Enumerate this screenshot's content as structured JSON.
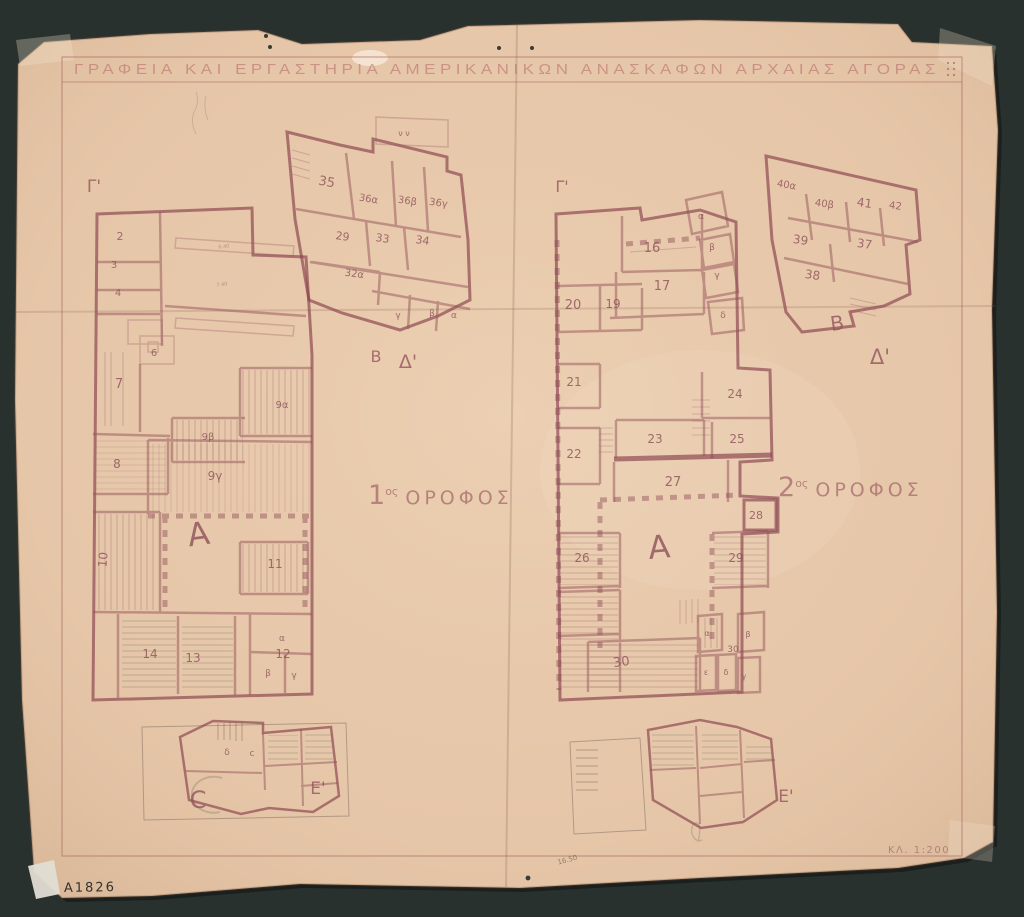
{
  "scene": {
    "title": "ΓΡΑΦΕΙΑ ΚΑΙ ΕΡΓΑΣΤΗΡΙΑ ΑΜΕΡΙΚΑΝΙΚΩΝ ΑΝΑΣΚΑΦΩΝ ΑΡΧΑΙΑΣ ΑΓΟΡΑΣ",
    "catalog_number": "A1826",
    "scale_label": "ΚΛ. 1:200",
    "background_color": "#2e3734",
    "paper_color": "#e8c8aa",
    "ink_color": "#9a5f68",
    "pencil_color": "#8a7568"
  },
  "floors": {
    "left": {
      "number": "1",
      "ordinal": "ος",
      "word": "ΟΡΟΦΟΣ"
    },
    "right": {
      "number": "2",
      "ordinal": "ος",
      "word": "ΟΡΟΦΟΣ"
    }
  },
  "plans": {
    "left": {
      "name": "first-floor-plan",
      "room_labels": [
        {
          "t": "2",
          "x": 120,
          "y": 240,
          "s": 11
        },
        {
          "t": "3",
          "x": 114,
          "y": 268,
          "s": 10
        },
        {
          "t": "4",
          "x": 118,
          "y": 296,
          "s": 10
        },
        {
          "t": "6",
          "x": 154,
          "y": 356,
          "s": 10
        },
        {
          "t": "7",
          "x": 119,
          "y": 388,
          "s": 13
        },
        {
          "t": "9α",
          "x": 282,
          "y": 408,
          "s": 10
        },
        {
          "t": "9β",
          "x": 208,
          "y": 440,
          "s": 10
        },
        {
          "t": "9γ",
          "x": 215,
          "y": 480,
          "s": 12
        },
        {
          "t": "8",
          "x": 117,
          "y": 468,
          "s": 12
        },
        {
          "t": "Α",
          "x": 200,
          "y": 545,
          "s": 32,
          "r": -8
        },
        {
          "t": "10",
          "x": 107,
          "y": 560,
          "s": 12,
          "r": -85
        },
        {
          "t": "11",
          "x": 275,
          "y": 568,
          "s": 12
        },
        {
          "t": "14",
          "x": 150,
          "y": 658,
          "s": 12
        },
        {
          "t": "13",
          "x": 193,
          "y": 662,
          "s": 12
        },
        {
          "t": "12",
          "x": 283,
          "y": 658,
          "s": 12
        },
        {
          "t": "α",
          "x": 282,
          "y": 641,
          "s": 9
        },
        {
          "t": "β",
          "x": 268,
          "y": 676,
          "s": 9
        },
        {
          "t": "γ",
          "x": 294,
          "y": 678,
          "s": 9
        },
        {
          "t": "35",
          "x": 326,
          "y": 186,
          "s": 13,
          "r": 10
        },
        {
          "t": "36α",
          "x": 368,
          "y": 202,
          "s": 10,
          "r": 9
        },
        {
          "t": "36β",
          "x": 407,
          "y": 204,
          "s": 10,
          "r": 8
        },
        {
          "t": "36γ",
          "x": 438,
          "y": 206,
          "s": 10,
          "r": 8
        },
        {
          "t": "29",
          "x": 342,
          "y": 240,
          "s": 11,
          "r": 8
        },
        {
          "t": "33",
          "x": 382,
          "y": 242,
          "s": 11,
          "r": 8
        },
        {
          "t": "34",
          "x": 422,
          "y": 244,
          "s": 11,
          "r": 8
        },
        {
          "t": "32α",
          "x": 354,
          "y": 277,
          "s": 10,
          "r": 8
        },
        {
          "t": "γ",
          "x": 398,
          "y": 318,
          "s": 9
        },
        {
          "t": "β",
          "x": 432,
          "y": 316,
          "s": 9
        },
        {
          "t": "α",
          "x": 454,
          "y": 318,
          "s": 9
        },
        {
          "t": "ν ν",
          "x": 404,
          "y": 136,
          "s": 8
        },
        {
          "t": "δ",
          "x": 227,
          "y": 755,
          "s": 9
        },
        {
          "t": "c",
          "x": 252,
          "y": 756,
          "s": 9
        }
      ],
      "section_marks": [
        {
          "t": "Γ'",
          "x": 94,
          "y": 192,
          "s": 17
        },
        {
          "t": "Β",
          "x": 376,
          "y": 362,
          "s": 16
        },
        {
          "t": "Δ'",
          "x": 408,
          "y": 368,
          "s": 19
        },
        {
          "t": "Ε'",
          "x": 318,
          "y": 794,
          "s": 17
        },
        {
          "t": "C",
          "x": 198,
          "y": 808,
          "s": 24
        }
      ],
      "dim_labels": [
        {
          "t": "6.40",
          "x": 224,
          "y": 248,
          "s": 5,
          "r": -6
        },
        {
          "t": "7.40",
          "x": 222,
          "y": 286,
          "s": 5,
          "r": -6
        }
      ]
    },
    "right": {
      "name": "second-floor-plan",
      "room_labels": [
        {
          "t": "16",
          "x": 652,
          "y": 252,
          "s": 13
        },
        {
          "t": "17",
          "x": 662,
          "y": 290,
          "s": 13
        },
        {
          "t": "α",
          "x": 701,
          "y": 219,
          "s": 9
        },
        {
          "t": "β",
          "x": 712,
          "y": 250,
          "s": 9
        },
        {
          "t": "γ",
          "x": 717,
          "y": 278,
          "s": 9
        },
        {
          "t": "δ",
          "x": 723,
          "y": 318,
          "s": 9
        },
        {
          "t": "19",
          "x": 613,
          "y": 308,
          "s": 12
        },
        {
          "t": "20",
          "x": 573,
          "y": 309,
          "s": 13
        },
        {
          "t": "21",
          "x": 574,
          "y": 386,
          "s": 12
        },
        {
          "t": "22",
          "x": 574,
          "y": 458,
          "s": 12
        },
        {
          "t": "23",
          "x": 655,
          "y": 443,
          "s": 12
        },
        {
          "t": "24",
          "x": 735,
          "y": 398,
          "s": 12
        },
        {
          "t": "25",
          "x": 737,
          "y": 443,
          "s": 12
        },
        {
          "t": "27",
          "x": 673,
          "y": 486,
          "s": 13
        },
        {
          "t": "28",
          "x": 756,
          "y": 519,
          "s": 11
        },
        {
          "t": "26",
          "x": 582,
          "y": 562,
          "s": 12
        },
        {
          "t": "29",
          "x": 736,
          "y": 562,
          "s": 12
        },
        {
          "t": "Α",
          "x": 660,
          "y": 558,
          "s": 32,
          "r": -5
        },
        {
          "t": "30",
          "x": 622,
          "y": 666,
          "s": 13,
          "r": -8
        },
        {
          "t": "30",
          "x": 733,
          "y": 652,
          "s": 9
        },
        {
          "t": "α",
          "x": 707,
          "y": 636,
          "s": 8
        },
        {
          "t": "β",
          "x": 748,
          "y": 637,
          "s": 8
        },
        {
          "t": "ε",
          "x": 706,
          "y": 675,
          "s": 8
        },
        {
          "t": "δ",
          "x": 726,
          "y": 675,
          "s": 8
        },
        {
          "t": "γ",
          "x": 744,
          "y": 679,
          "s": 8
        },
        {
          "t": "40α",
          "x": 786,
          "y": 188,
          "s": 10,
          "r": 10
        },
        {
          "t": "40β",
          "x": 824,
          "y": 207,
          "s": 10,
          "r": 8
        },
        {
          "t": "41",
          "x": 864,
          "y": 207,
          "s": 12,
          "r": 8
        },
        {
          "t": "42",
          "x": 895,
          "y": 209,
          "s": 10,
          "r": 8
        },
        {
          "t": "39",
          "x": 800,
          "y": 244,
          "s": 12,
          "r": 8
        },
        {
          "t": "37",
          "x": 864,
          "y": 248,
          "s": 12,
          "r": 8
        },
        {
          "t": "38",
          "x": 812,
          "y": 279,
          "s": 12,
          "r": 8
        }
      ],
      "section_marks": [
        {
          "t": "Γ'",
          "x": 562,
          "y": 192,
          "s": 16
        },
        {
          "t": "Β",
          "x": 838,
          "y": 330,
          "s": 20,
          "r": -8
        },
        {
          "t": "Δ'",
          "x": 880,
          "y": 364,
          "s": 21
        },
        {
          "t": "Ε'",
          "x": 786,
          "y": 802,
          "s": 17
        }
      ],
      "dim_labels": []
    }
  },
  "pencil_notes": [
    {
      "t": "16.50",
      "x": 568,
      "y": 862,
      "s": 7,
      "r": -15
    },
    {
      "t": "5.",
      "x": 40,
      "y": 880,
      "s": 8
    }
  ]
}
